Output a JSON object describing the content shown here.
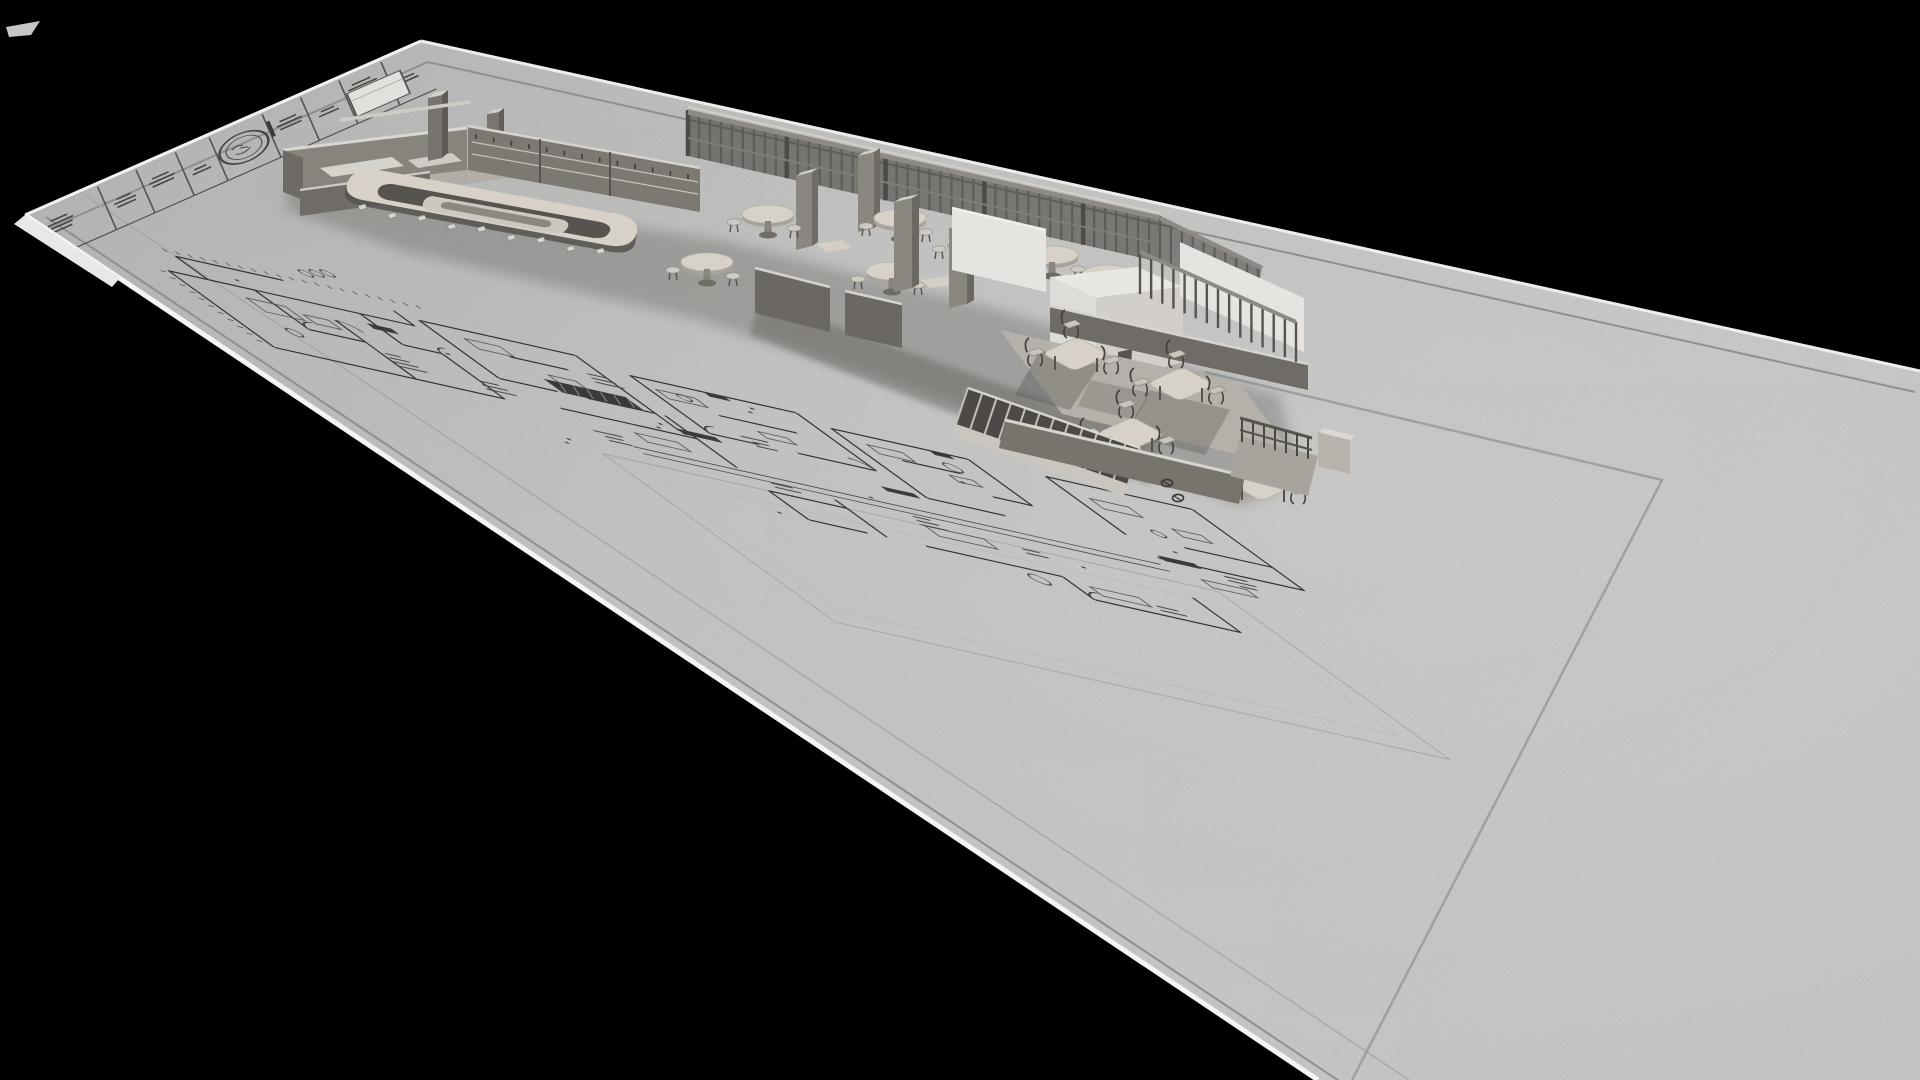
{
  "meta": {
    "description": "3D architectural visualization: a restaurant interior model extruded from a blueprint floor-plan sheet lying on a black background"
  },
  "scene": {
    "labels": {
      "sheet": "blueprint sheet",
      "title_block": "title block strip",
      "stamp": "approval stamp",
      "floor_plan": "2D floor plan linework",
      "model": "3D building model",
      "kitchen": "kitchen block",
      "bar": "bar counter",
      "pergola": "pergola slat screen",
      "cafe_tables": "cafe tables",
      "rooftop_volume": "white rooftop volume",
      "staircase": "staircase",
      "dining": "dining room",
      "balcony": "balcony railing"
    }
  },
  "palette": {
    "bg": "#000000",
    "paper": "#d8d8d6",
    "paperDark": "#c8c8c6",
    "rim": "#f2f2f0",
    "planDark": "#34332f",
    "planMid": "#56544f",
    "planFaint": "#a0a09e",
    "borderLine": "#8f8f8d",
    "wallLight": "#dad7d1",
    "wallMid": "#8b8780",
    "wallDark": "#5d5a55",
    "wallDarker": "#474441",
    "topBeige": "#d8d1c7",
    "floorGray": "#b5b1aa",
    "whiteWall": "#e6e4e0",
    "shadow": "#524f4b",
    "slat": "#605c58",
    "metal": "#45423e"
  }
}
